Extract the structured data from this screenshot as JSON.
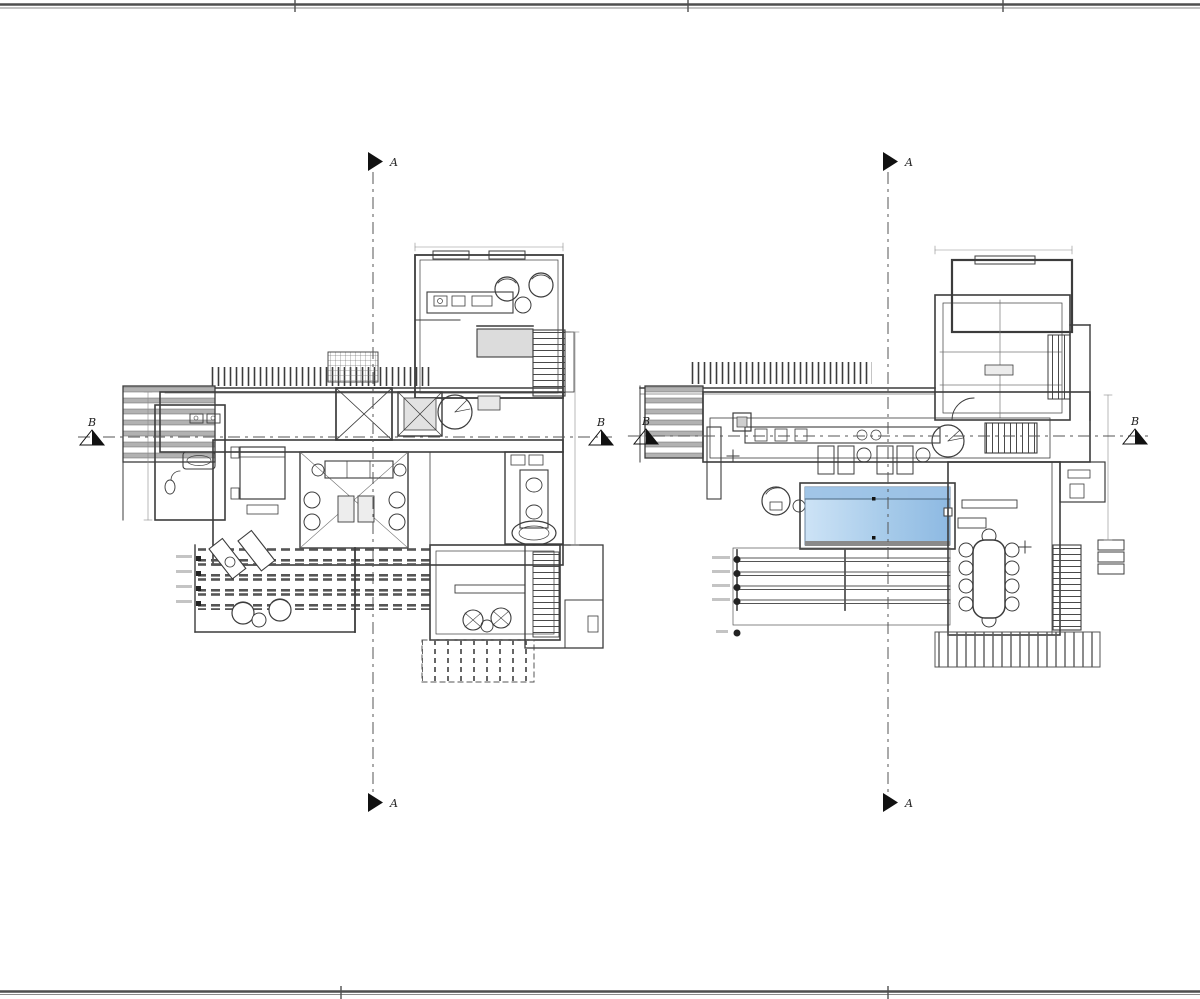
{
  "sheet": {
    "type": "architectural floor plan drawing",
    "background": "#ffffff",
    "border_color": "#4f4f4f",
    "line_color": "#3c3c3c"
  },
  "section_markers": {
    "a_label": "A",
    "b_label": "B"
  },
  "markers": [
    {
      "label": "A",
      "location": "left-plan-top"
    },
    {
      "label": "A",
      "location": "left-plan-bottom"
    },
    {
      "label": "B",
      "location": "left-plan-left"
    },
    {
      "label": "B",
      "location": "left-plan-right"
    },
    {
      "label": "A",
      "location": "right-plan-top"
    },
    {
      "label": "A",
      "location": "right-plan-bottom"
    },
    {
      "label": "B",
      "location": "right-plan-left"
    },
    {
      "label": "B",
      "location": "right-plan-right"
    }
  ],
  "pool": {
    "fill_start": "#cde3f6",
    "fill_mid": "#a7cbea",
    "fill_end": "#8db9e2",
    "top_band": "#9cc2e6",
    "edge": "#6b86a0"
  }
}
